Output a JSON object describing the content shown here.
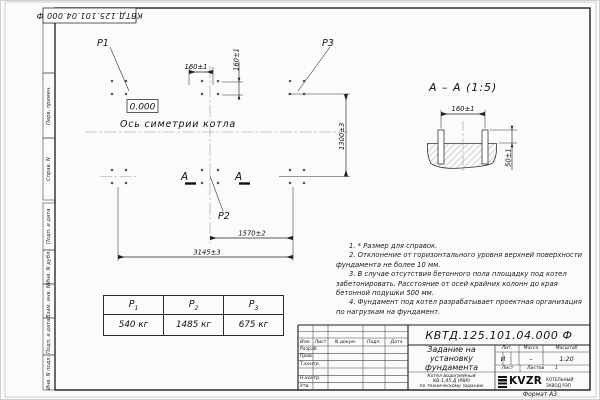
{
  "sheet": {
    "doc_number_top": "КВТД.125.101.04.000  Ф",
    "format_note": "Формат А3"
  },
  "margin_labels": [
    "Перв. примен.",
    "Справ. N",
    "Подп. и дата",
    "Инв. N дубл.",
    "Взам. инв. N",
    "Подп. и дата",
    "Инв. N подл."
  ],
  "plan": {
    "point_labels": {
      "p1": "P1",
      "p2": "P2",
      "p3": "P3"
    },
    "level_mark": "0.000",
    "axis_label": "Ось симетрии котла",
    "section_letter": "А",
    "dims": {
      "h160": "160±1",
      "v160": "160±1",
      "v1300": "1300±3",
      "h1570": "1570±2",
      "h3145": "3145±3"
    }
  },
  "section_view": {
    "title": "А – А (1:5)",
    "dims": {
      "h160": "160±1",
      "v50": "50±1"
    }
  },
  "load_table": {
    "headers": [
      {
        "base": "P",
        "sub": "1"
      },
      {
        "base": "P",
        "sub": "2"
      },
      {
        "base": "P",
        "sub": "3"
      }
    ],
    "values": [
      "540 кг",
      "1485 кг",
      "675 кг"
    ]
  },
  "notes": [
    "1. * Размер для справок.",
    "2. Отклонение от горизонтального уровня верхней поверхности фундамента не более 10 мм.",
    "3. В случае отсутствия бетонного пола площадку под котел забетонировать. Расстояние от осей крайних колонн до края бетонной подушки 500 мм.",
    "4. Фундамент под котел разрабатывает проектная организация по нагрузкам на фундамент."
  ],
  "title_block": {
    "doc_number": "КВТД.125.101.04.000  Ф",
    "title_lines": [
      "Задание на",
      "установку",
      "фундамента"
    ],
    "subtitle_lines": [
      "Котел водогрейный",
      "КВ-1,45 Д (РВР)",
      "по техническому заданию"
    ],
    "columns": [
      "Изм.",
      "Лист",
      "N докум.",
      "Подп.",
      "Дата"
    ],
    "rows": [
      "Разраб.",
      "Пров.",
      "Т.контр.",
      "Н.контр.",
      "Утв."
    ],
    "lit": {
      "header": "Лит.",
      "value": "И"
    },
    "mass": {
      "header": "Масса",
      "value": "–"
    },
    "scale": {
      "header": "Масштаб",
      "value": "1:20"
    },
    "sheet_col": {
      "label": "Лист"
    },
    "sheets_col": {
      "label": "Листов",
      "value": "1"
    },
    "logo_text": "KVZR",
    "company_lines": [
      "КОТЕЛЬНЫЙ",
      "ЗАВОД РЭП"
    ]
  }
}
